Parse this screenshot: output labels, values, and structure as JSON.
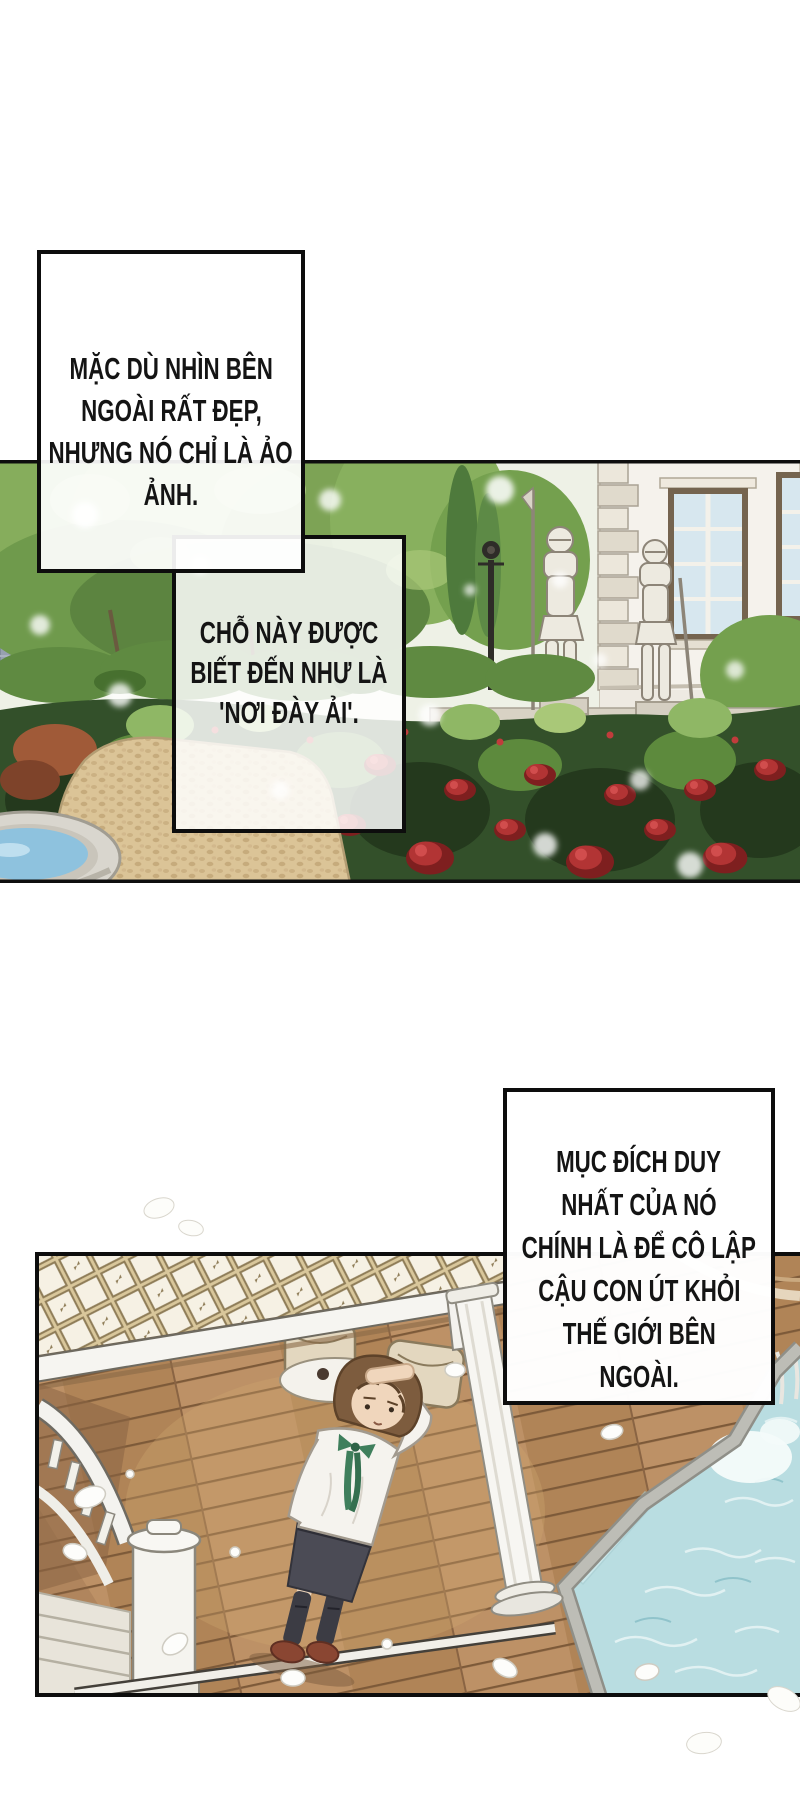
{
  "page": {
    "width": 800,
    "height": 1800,
    "background": "#ffffff"
  },
  "narration_boxes": [
    {
      "id": "box1",
      "lines": [
        "MẶC DÙ NHÌN BÊN",
        "NGOÀI RẤT ĐẸP,",
        "NHƯNG NÓ CHỈ LÀ ẢO",
        "ẢNH."
      ]
    },
    {
      "id": "box2",
      "lines": [
        "CHỖ NÀY ĐƯỢC",
        "BIẾT ĐẾN NHƯ LÀ",
        "'NƠI ĐÀY ẢI'."
      ]
    },
    {
      "id": "box3",
      "lines": [
        "MỤC ĐÍCH DUY",
        "NHẤT CỦA NÓ",
        "CHÍNH LÀ ĐỂ CÔ LẬP",
        "CẬU CON ÚT KHỎI",
        "THẾ GIỚI BÊN",
        "NGOÀI."
      ]
    }
  ],
  "panels": [
    {
      "id": "garden",
      "label": "Mansion garden with rose beds, two suits of armor, lamppost, stone wall and fountain"
    },
    {
      "id": "deck",
      "label": "Boy in white shirt with green ribbon standing on a wooden deck under a glass canopy beside a swimming pool"
    }
  ],
  "colors": {
    "ink": "#111111",
    "paper": "#ffffff",
    "foliage": "#6f9a4c",
    "rose": "#b23434",
    "path": "#dbc497",
    "deck_wood": "#b68c60",
    "pool_water": "#b9dde1",
    "fountain_water": "#8ec2de",
    "border": "#0d0d0d"
  }
}
